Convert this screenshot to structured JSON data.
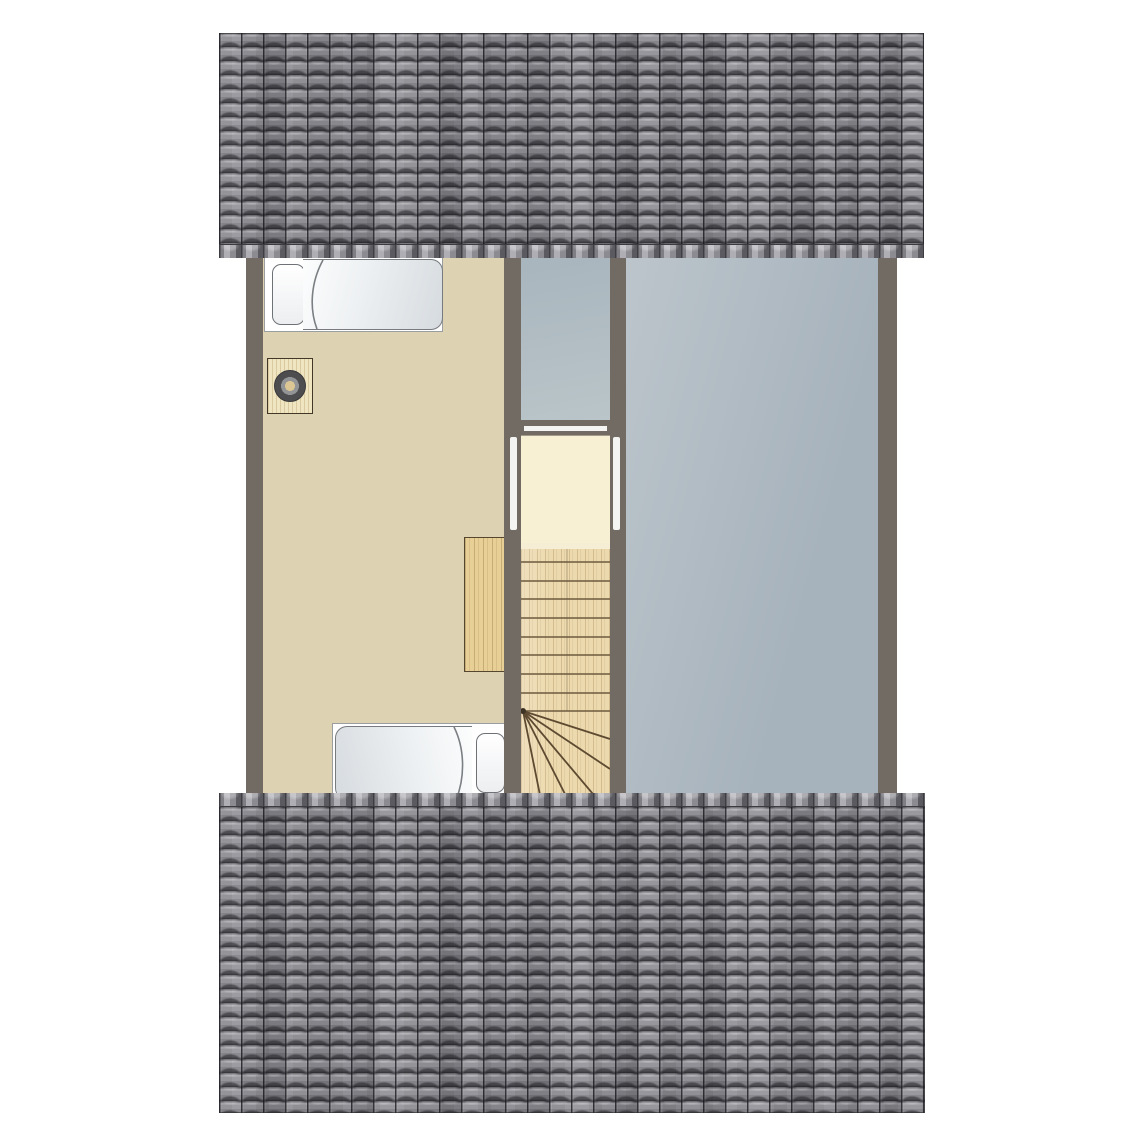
{
  "document": {
    "kind": "attic floor plan drawing",
    "visible_text": []
  },
  "colors": {
    "page_bg": "#ffffff",
    "wall": "#716b64",
    "bedroom_floor": "#ddd2b1",
    "closet_floor": "#f8f0d3",
    "void_upper_a": "#a8b5bd",
    "void_upper_b": "#bac5c9",
    "void_right_a": "#bcc5cb",
    "void_right_b": "#a6b2bc",
    "track_white": "#f4f4f2",
    "stairs_wood": "#ecd9ae",
    "stairs_line": "#6d5a3e",
    "winder_line": "#5d4a31",
    "desk_wood": "#e7cf96",
    "desk_line": "#55462f",
    "nightstand_wood": "#f0e5c1",
    "nightstand_line": "#413828",
    "lamp_outer": "#4d4d50",
    "lamp_ring": "#939496",
    "lamp_center": "#dcc794",
    "bed_frame": "#ffffff",
    "bed_edge": "#9b9ea1",
    "pillow_edge": "#6e7276",
    "duvet_edge": "#777b7f",
    "duvet_a": "#fcfdfd",
    "duvet_b": "#d6dbdf",
    "roof_base": "#89898e",
    "roof_row_dark": "#46464c",
    "roof_row_light": "#9c9ca2"
  },
  "plan": {
    "roofs": [
      {
        "name": "roof-upper",
        "position": "top"
      },
      {
        "name": "roof-lower",
        "position": "bottom"
      }
    ],
    "areas": [
      {
        "name": "bedroom-floor",
        "type": "room"
      },
      {
        "name": "closet-floor",
        "type": "closet"
      },
      {
        "name": "attic-void-upper",
        "type": "unfinished-space"
      },
      {
        "name": "attic-void-right",
        "type": "unfinished-space"
      }
    ],
    "furniture": [
      {
        "name": "single-bed-top",
        "pillow_side": "left"
      },
      {
        "name": "single-bed-bottom",
        "pillow_side": "right"
      },
      {
        "name": "nightstand"
      },
      {
        "name": "table-lamp"
      },
      {
        "name": "desk"
      },
      {
        "name": "staircase",
        "straight_treads": 9,
        "winder_treads": 5
      }
    ]
  }
}
